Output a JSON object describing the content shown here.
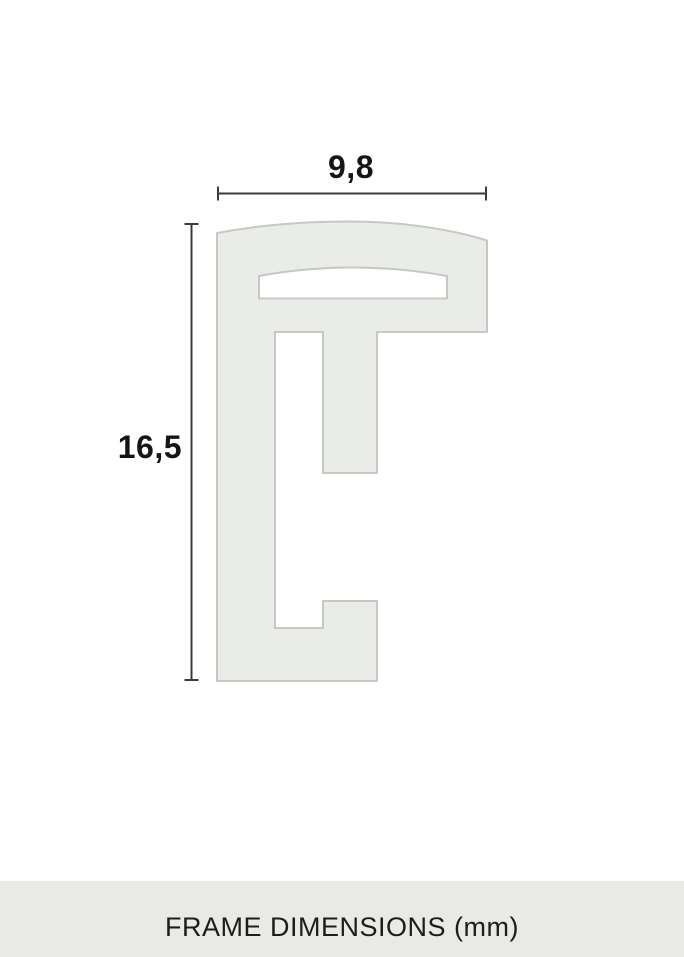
{
  "diagram": {
    "title": "Frame profile cross-section",
    "width_label": "9,8",
    "height_label": "16,5",
    "width_value_mm": 9.8,
    "height_value_mm": 16.5,
    "unit": "mm",
    "caption": "FRAME DIMENSIONS (mm)",
    "colors": {
      "background": "#ffffff",
      "profile_fill": "#e9ece7",
      "profile_stroke": "#c5c8c3",
      "dimension_line": "#3b3b3b",
      "label_text": "#151515",
      "caption_text": "#1d1d1d",
      "caption_band": "#e9e9e5"
    }
  }
}
